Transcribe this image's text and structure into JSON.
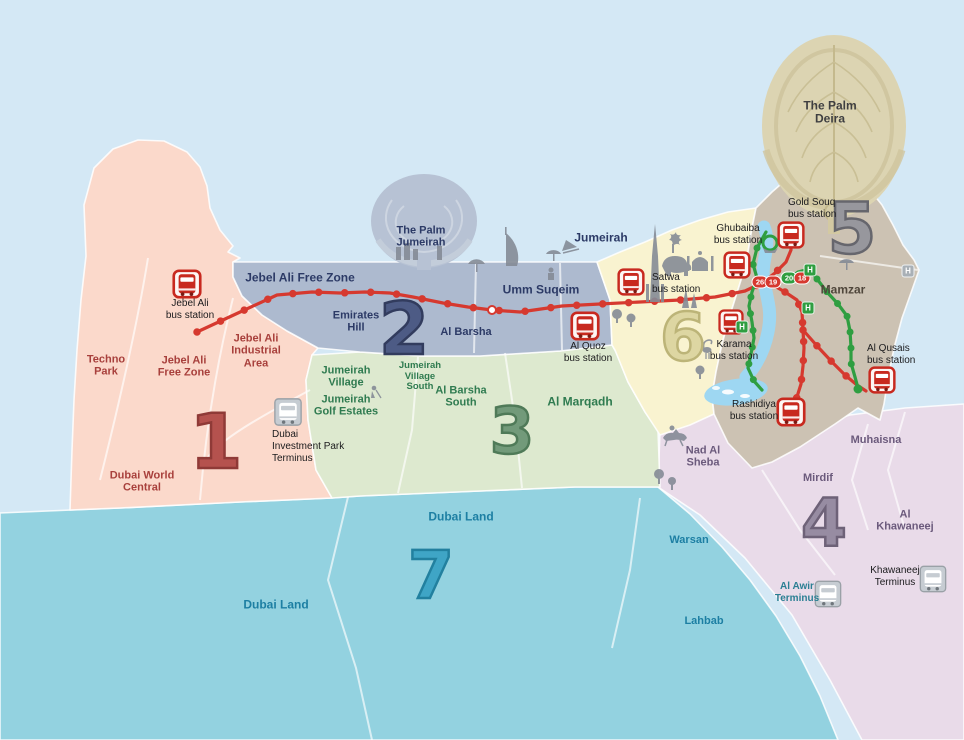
{
  "map_title": "Dubai bus network zone map",
  "h_label": "H",
  "colors": {
    "sea": "#d4e8f5",
    "zone1": "#fbd9cb",
    "zone2": "#adbacf",
    "zone3": "#dde9cf",
    "zone4": "#e9dbe9",
    "zone5": "#ccc2b3",
    "zone6": "#f9f3d0",
    "zone7": "#93d2e0",
    "red_route": "#d6392f",
    "green_route": "#2f9e41",
    "creek": "#9ed7f2",
    "station_icon_red": "#c8291f",
    "text_navy": "#2c3a66",
    "text_dark_red": "#a8403c",
    "text_green": "#2f7b50",
    "text_purple": "#6b5a7c",
    "text_teal": "#1d7fa3"
  },
  "zones": [
    {
      "numeral": "1",
      "labels": [
        "Techno\nPark",
        "Jebel Ali\nFree Zone",
        "Jebel Ali\nIndustrial\nArea",
        "Dubai World\nCentral"
      ]
    },
    {
      "numeral": "2",
      "labels": [
        "Jebel Ali Free Zone",
        "Emirates\nHill",
        "Al Barsha",
        "Umm Suqeim",
        "Jumeirah"
      ]
    },
    {
      "numeral": "3",
      "labels": [
        "Jumeirah\nVillage",
        "Jumeirah\nGolf Estates",
        "Jumeirah\nVillage\nSouth",
        "Al Barsha\nSouth",
        "Al Marqadh"
      ]
    },
    {
      "numeral": "4",
      "labels": [
        "Nad Al\nSheba",
        "Muhaisna",
        "Mirdif",
        "Al Khawaneej"
      ]
    },
    {
      "numeral": "5",
      "labels": [
        "Mamzar"
      ]
    },
    {
      "numeral": "6",
      "labels": []
    },
    {
      "numeral": "7",
      "labels": [
        "Dubai Land",
        "Dubai Land",
        "Warsan",
        "Lahbab"
      ]
    }
  ],
  "landmarks": {
    "palm_jumeirah": "The Palm\nJumeirah",
    "palm_deira": "The Palm\nDeira"
  },
  "stations": [
    {
      "label": "Jebel Ali\nbus station"
    },
    {
      "label": "Satwa\nbus station"
    },
    {
      "label": "Al Quoz\nbus station"
    },
    {
      "label": "Ghubaiba\nbus station"
    },
    {
      "label": "Gold Souq\nbus station"
    },
    {
      "label": "Karama\nbus station"
    },
    {
      "label": "Rashidiya\nbus station"
    },
    {
      "label": "Al Qusais\nbus station"
    }
  ],
  "termini": [
    {
      "label": "Dubai\nInvestment Park\nTerminus"
    },
    {
      "label": "Al Awir\nTerminus"
    },
    {
      "label": "Khawaneej\nTerminus"
    }
  ],
  "route_badges": [
    {
      "route": "26",
      "line": "red"
    },
    {
      "route": "19",
      "line": "red"
    },
    {
      "route": "20",
      "line": "green"
    },
    {
      "route": "18",
      "line": "red"
    }
  ]
}
